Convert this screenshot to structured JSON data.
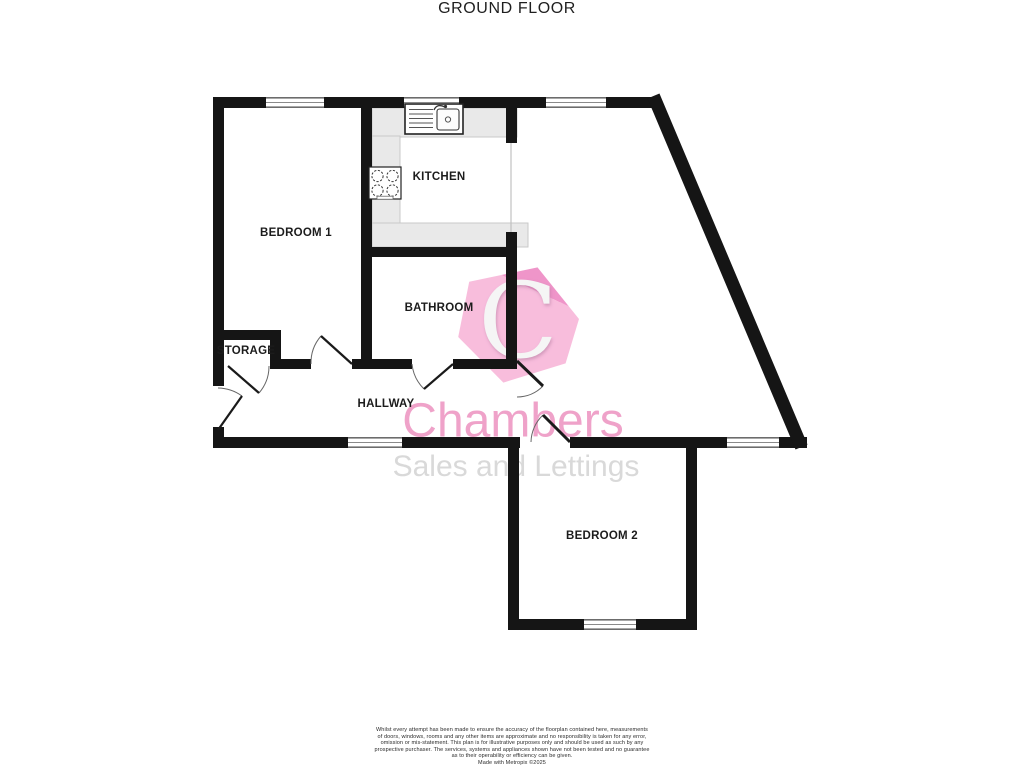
{
  "page": {
    "title": "GROUND FLOOR"
  },
  "floorplan": {
    "wall_color": "#151515",
    "counter_color": "#e9e9e9",
    "rooms": [
      {
        "id": "bedroom-1",
        "label": "BEDROOM 1"
      },
      {
        "id": "kitchen",
        "label": "KITCHEN"
      },
      {
        "id": "bathroom",
        "label": "BATHROOM"
      },
      {
        "id": "storage",
        "label": "STORAGE"
      },
      {
        "id": "hallway",
        "label": "HALLWAY"
      },
      {
        "id": "bedroom-2",
        "label": "BEDROOM 2"
      }
    ],
    "fixtures": [
      {
        "name": "kitchen-sink-icon"
      },
      {
        "name": "cooker-hob-icon"
      }
    ]
  },
  "watermark": {
    "logo_letter": "C",
    "brand": "Chambers",
    "tagline": "Sales and Lettings",
    "brand_color": "#efa2c9",
    "logo_color": "#f7b0d6",
    "tagline_color": "#d9d9d9"
  },
  "disclaimer": {
    "lines": [
      "Whilst every attempt has been made to ensure the accuracy of the floorplan contained here, measurements",
      "of doors, windows, rooms and any other items are approximate and no responsibility is taken for any error,",
      "omission or mis-statement. This plan is for illustrative purposes only and should be used as such by any",
      "prospective purchaser. The services, systems and appliances shown have not been tested and no guarantee",
      "as to their operability or efficiency can be given.",
      "Made with Metropix ©2025"
    ]
  }
}
